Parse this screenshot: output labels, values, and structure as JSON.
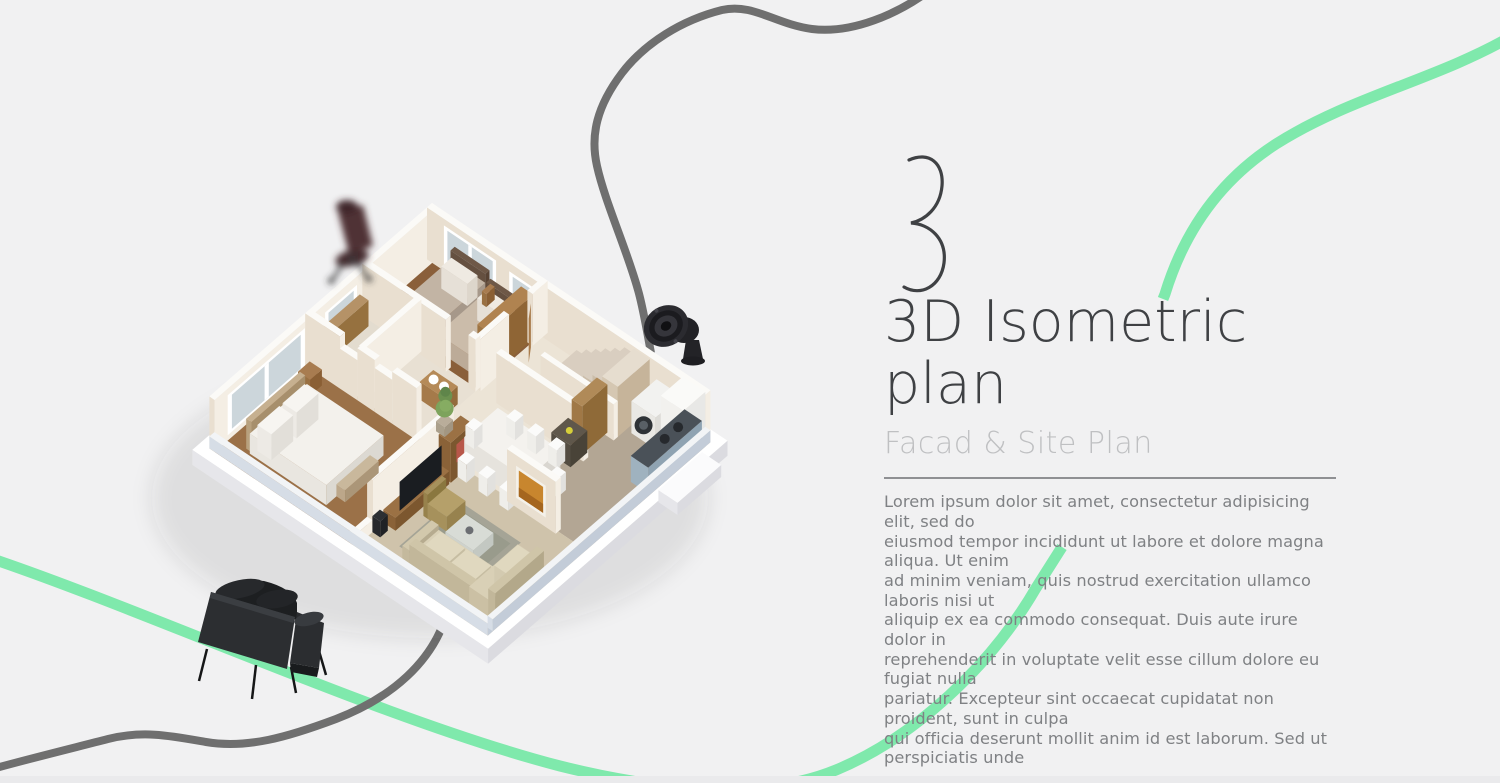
{
  "section": {
    "number": "3",
    "title": "3D Isometric plan",
    "subtitle": "Facad & Site Plan",
    "body": "Lorem ipsum dolor sit amet, consectetur adipisicing elit, sed do\neiusmod tempor incididunt ut labore et dolore magna aliqua. Ut enim\nad minim veniam, quis nostrud exercitation ullamco laboris nisi ut\naliquip ex ea commodo consequat. Duis aute irure dolor in\nreprehenderit in voluptate velit esse cillum dolore eu fugiat nulla\npariatur. Excepteur sint occaecat cupidatat non proident, sunt in culpa\nqui officia deserunt mollit anim id est laborum. Sed ut perspiciatis unde"
  },
  "illustration": {
    "floor_plan_alt": "3D isometric apartment floor plan with two bedrooms, bathroom, living room, dining area, kitchen and stairs",
    "sofa_alt": "black leather sofa",
    "chair_alt": "blurred dark red office chair",
    "speaker_alt": "black round speaker"
  },
  "colors": {
    "background": "#f1f1f2",
    "accent_green": "#7fe9ac",
    "curve_gray": "#6f6f6f",
    "title_color": "#3f4144",
    "subtitle_color": "#bfc0c2",
    "body_color": "#7f8184",
    "divider_color": "#8f9093"
  }
}
